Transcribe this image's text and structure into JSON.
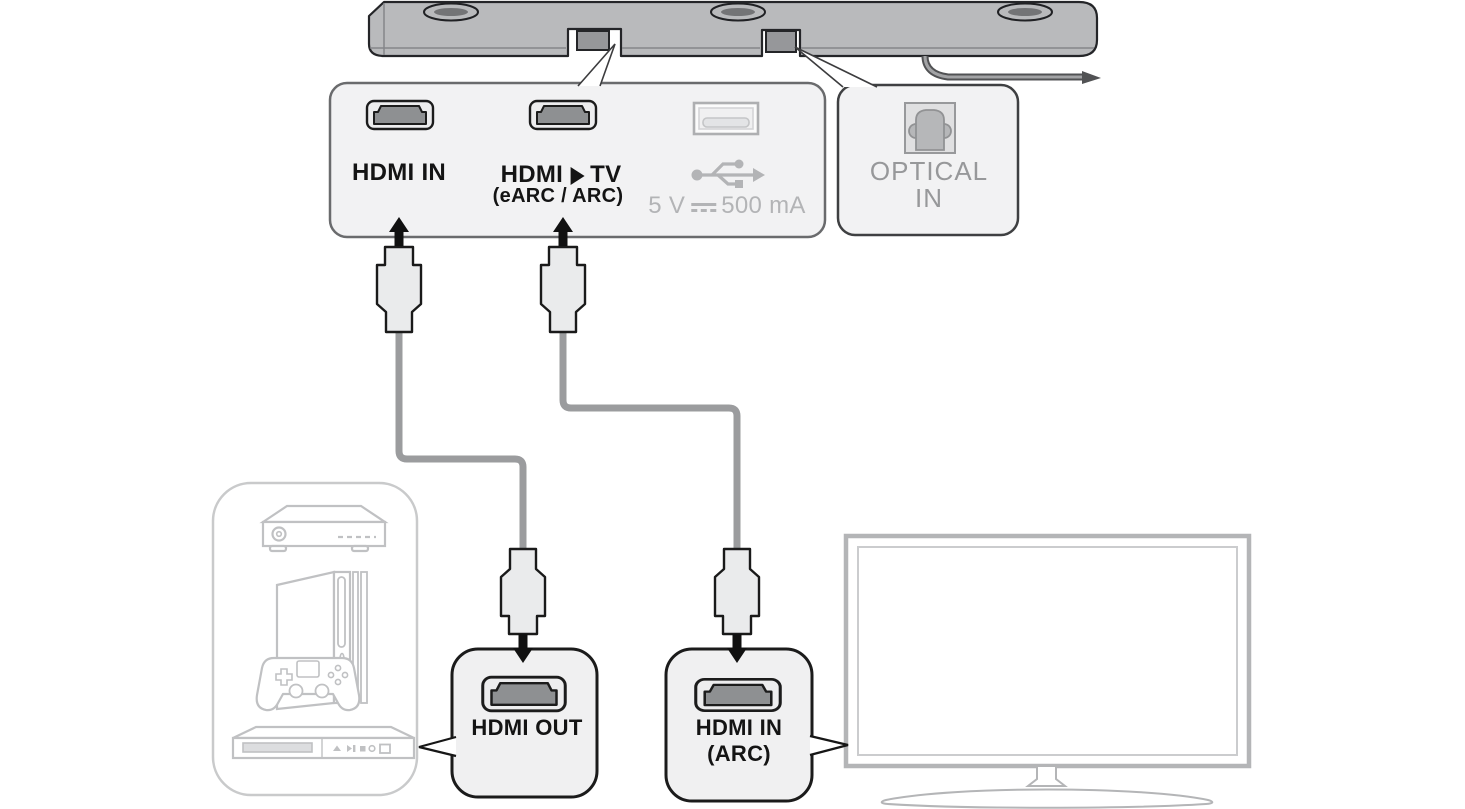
{
  "ports_panel": {
    "hdmi_in_label": "HDMI IN",
    "hdmi_tv_prefix": "HDMI",
    "hdmi_tv_suffix": "TV",
    "hdmi_tv_sub": "(eARC / ARC)",
    "usb_voltage": "5 V",
    "usb_current": "500 mA"
  },
  "optical_panel": {
    "line1": "OPTICAL",
    "line2": "IN"
  },
  "hdmi_out_box": {
    "label": "HDMI OUT"
  },
  "hdmi_in_arc_box": {
    "line1": "HDMI IN",
    "line2": "(ARC)"
  },
  "icons": {
    "soundbar": "soundbar-bottom-icon",
    "hdmi_port": "hdmi-port-icon",
    "usb_port": "usb-port-icon",
    "usb_symbol": "usb-trident-icon",
    "dc_symbol": "dc-current-icon",
    "right_triangle": "right-triangle-icon",
    "optical_port": "optical-port-icon",
    "hdmi_plug": "hdmi-plug-icon",
    "arrow": "connection-arrow-icon",
    "set_top_box": "set-top-box-icon",
    "game_console": "game-console-icon",
    "controller": "game-controller-icon",
    "bluray_player": "bluray-player-icon",
    "tv": "tv-icon"
  },
  "colors": {
    "soundbar_gray": "#b9babc",
    "panel_fill": "#f2f2f3",
    "outline_dark": "#1b1b1b",
    "muted_gray": "#b3b4b6",
    "label_gray": "#97989a",
    "cable_gray": "#9b9c9e",
    "device_outline": "#c0c1c3",
    "tv_outline": "#b4b5b7"
  }
}
